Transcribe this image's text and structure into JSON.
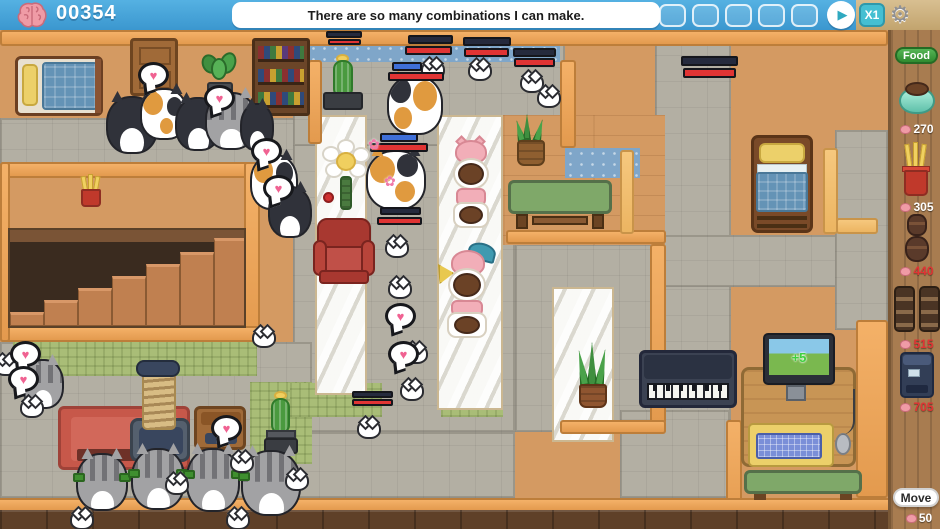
{
  "topbar": {
    "score": "00354",
    "message": "There are so many combinations I can make.",
    "speed": "X1"
  },
  "icons": {
    "heart": "♥",
    "sparkle": "✿",
    "play": "▶",
    "gear": "⚙",
    "monitor_bonus": "+5"
  },
  "sidebar": {
    "category": "Food",
    "items": [
      {
        "label": "food-bowl",
        "price": "270"
      },
      {
        "label": "fry-treats",
        "price": "305"
      },
      {
        "label": "barrel-feeder",
        "price": "440"
      },
      {
        "label": "double-feeder",
        "price": "515"
      },
      {
        "label": "food-machine",
        "price": "705"
      }
    ],
    "move_label": "Move",
    "move_cost": "50"
  },
  "colors": {
    "topbar_blue": "#3b97cf",
    "accent_teal": "#45bfd2",
    "wall_orange": "#efa557",
    "wood_floor": "#d49a62",
    "stone_path": "#b3afa3",
    "plaid_green": "#a9bd77",
    "blue_tile": "#7fa6c9",
    "price_red": "#e03434",
    "food_green": "#2f8a2f",
    "heart_pink": "#f06292"
  }
}
